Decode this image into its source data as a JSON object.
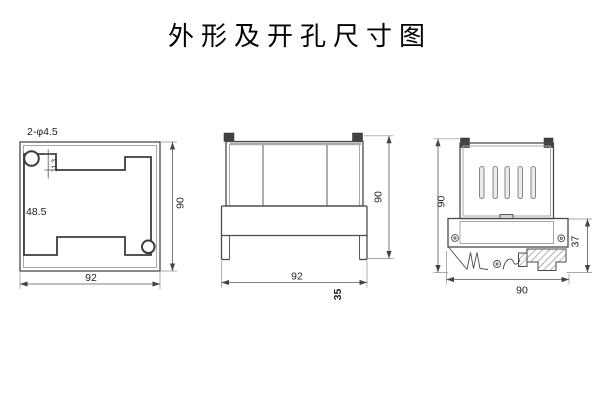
{
  "title": "外形及开孔尺寸图",
  "colors": {
    "background": "#ffffff",
    "line": "#4a4a4a",
    "dim_line": "#555555",
    "text": "#222222",
    "tab_fill": "#424242",
    "slot_fill": "#ececec"
  },
  "cutout_view": {
    "holes_label": "2-φ4.5",
    "step_height": "11.3",
    "middle_height": "48.5",
    "width": "92",
    "height": "90"
  },
  "front_view": {
    "height": "90",
    "width": "92",
    "depth": "35"
  },
  "side_view": {
    "height": "90",
    "bracket_depth": "37",
    "width": "90"
  }
}
